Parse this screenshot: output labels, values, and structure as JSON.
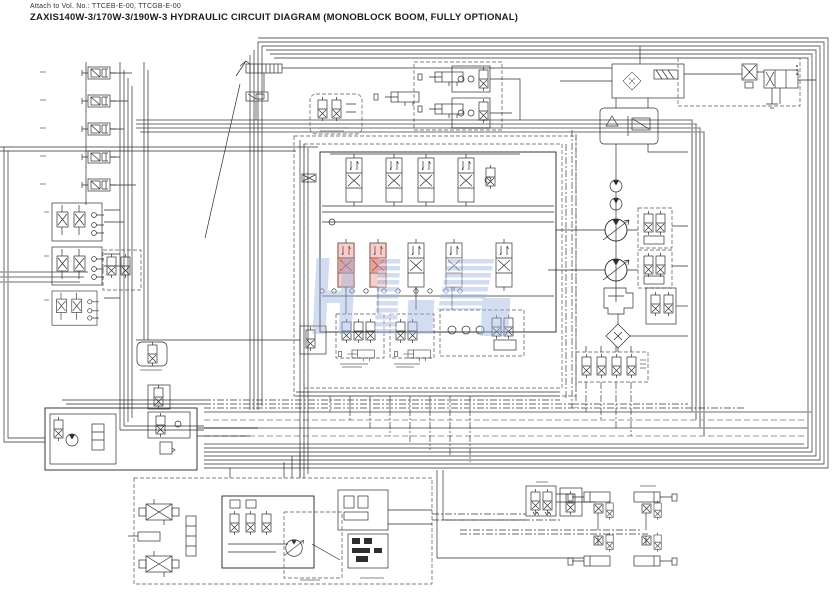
{
  "header": {
    "attach_note": "Attach to Vol. No.: TTCEB-E-00, TTCGB-E-00",
    "title": "ZAXIS140W-3/170W-3/190W-3 HYDRAULIC CIRCUIT DIAGRAM (MONOBLOCK BOOM, FULLY OPTIONAL)"
  },
  "diagram": {
    "type": "hydraulic-circuit-schematic",
    "machine_models": [
      "ZAXIS140W-3",
      "ZAXIS170W-3",
      "ZAXIS190W-3"
    ],
    "configuration": "MONOBLOCK BOOM, FULLY OPTIONAL",
    "colors": {
      "background": "#ffffff",
      "line": "#2e2e2e",
      "pilot_bundle_gray": "#9d9d9d",
      "dashed_boundary": "#555555",
      "highlight_red_fill": "#e2543f",
      "watermark_blue": "#9fb4e4"
    },
    "highlight": {
      "note": "two valve sections in lower spool row tinted red/pink",
      "color": "#e2543f"
    },
    "watermark": {
      "present": true,
      "style": "large translucent blue logo letters across center of drawing",
      "color": "#9fb4e4"
    },
    "components": [
      "pilot-solenoid-valve-bank-left",
      "remote-pilot-valve-group-left",
      "pilot-shutoff-dashed-block",
      "hand-lever-and-linkage-top-center",
      "pilot-damper-box-top-center",
      "cylinder-valve-assemblies-top-center",
      "main-control-valve-monoblock",
      "highlighted-valve-sections",
      "pilot-manifold-clusters-below-valve",
      "oil-cooler-with-bypass-check",
      "return-filter-tank-block",
      "solenoid-unit-top-right",
      "relief-valve-block-top-right",
      "pilot-gear-pumps",
      "main-variable-displacement-pumps",
      "pump-regulator-blocks",
      "hydraulic-oil-tank",
      "suction-filter",
      "four-spool-solenoid-manifold",
      "accumulator-pilot-block-bottom-left",
      "steering-priority-circuit-bottom-left",
      "axle-lock-cylinder-group",
      "outrigger-blade-pilot-boxes",
      "outrigger-blade-cylinders",
      "hose-bundle-buses",
      "watermark-overlay"
    ]
  }
}
